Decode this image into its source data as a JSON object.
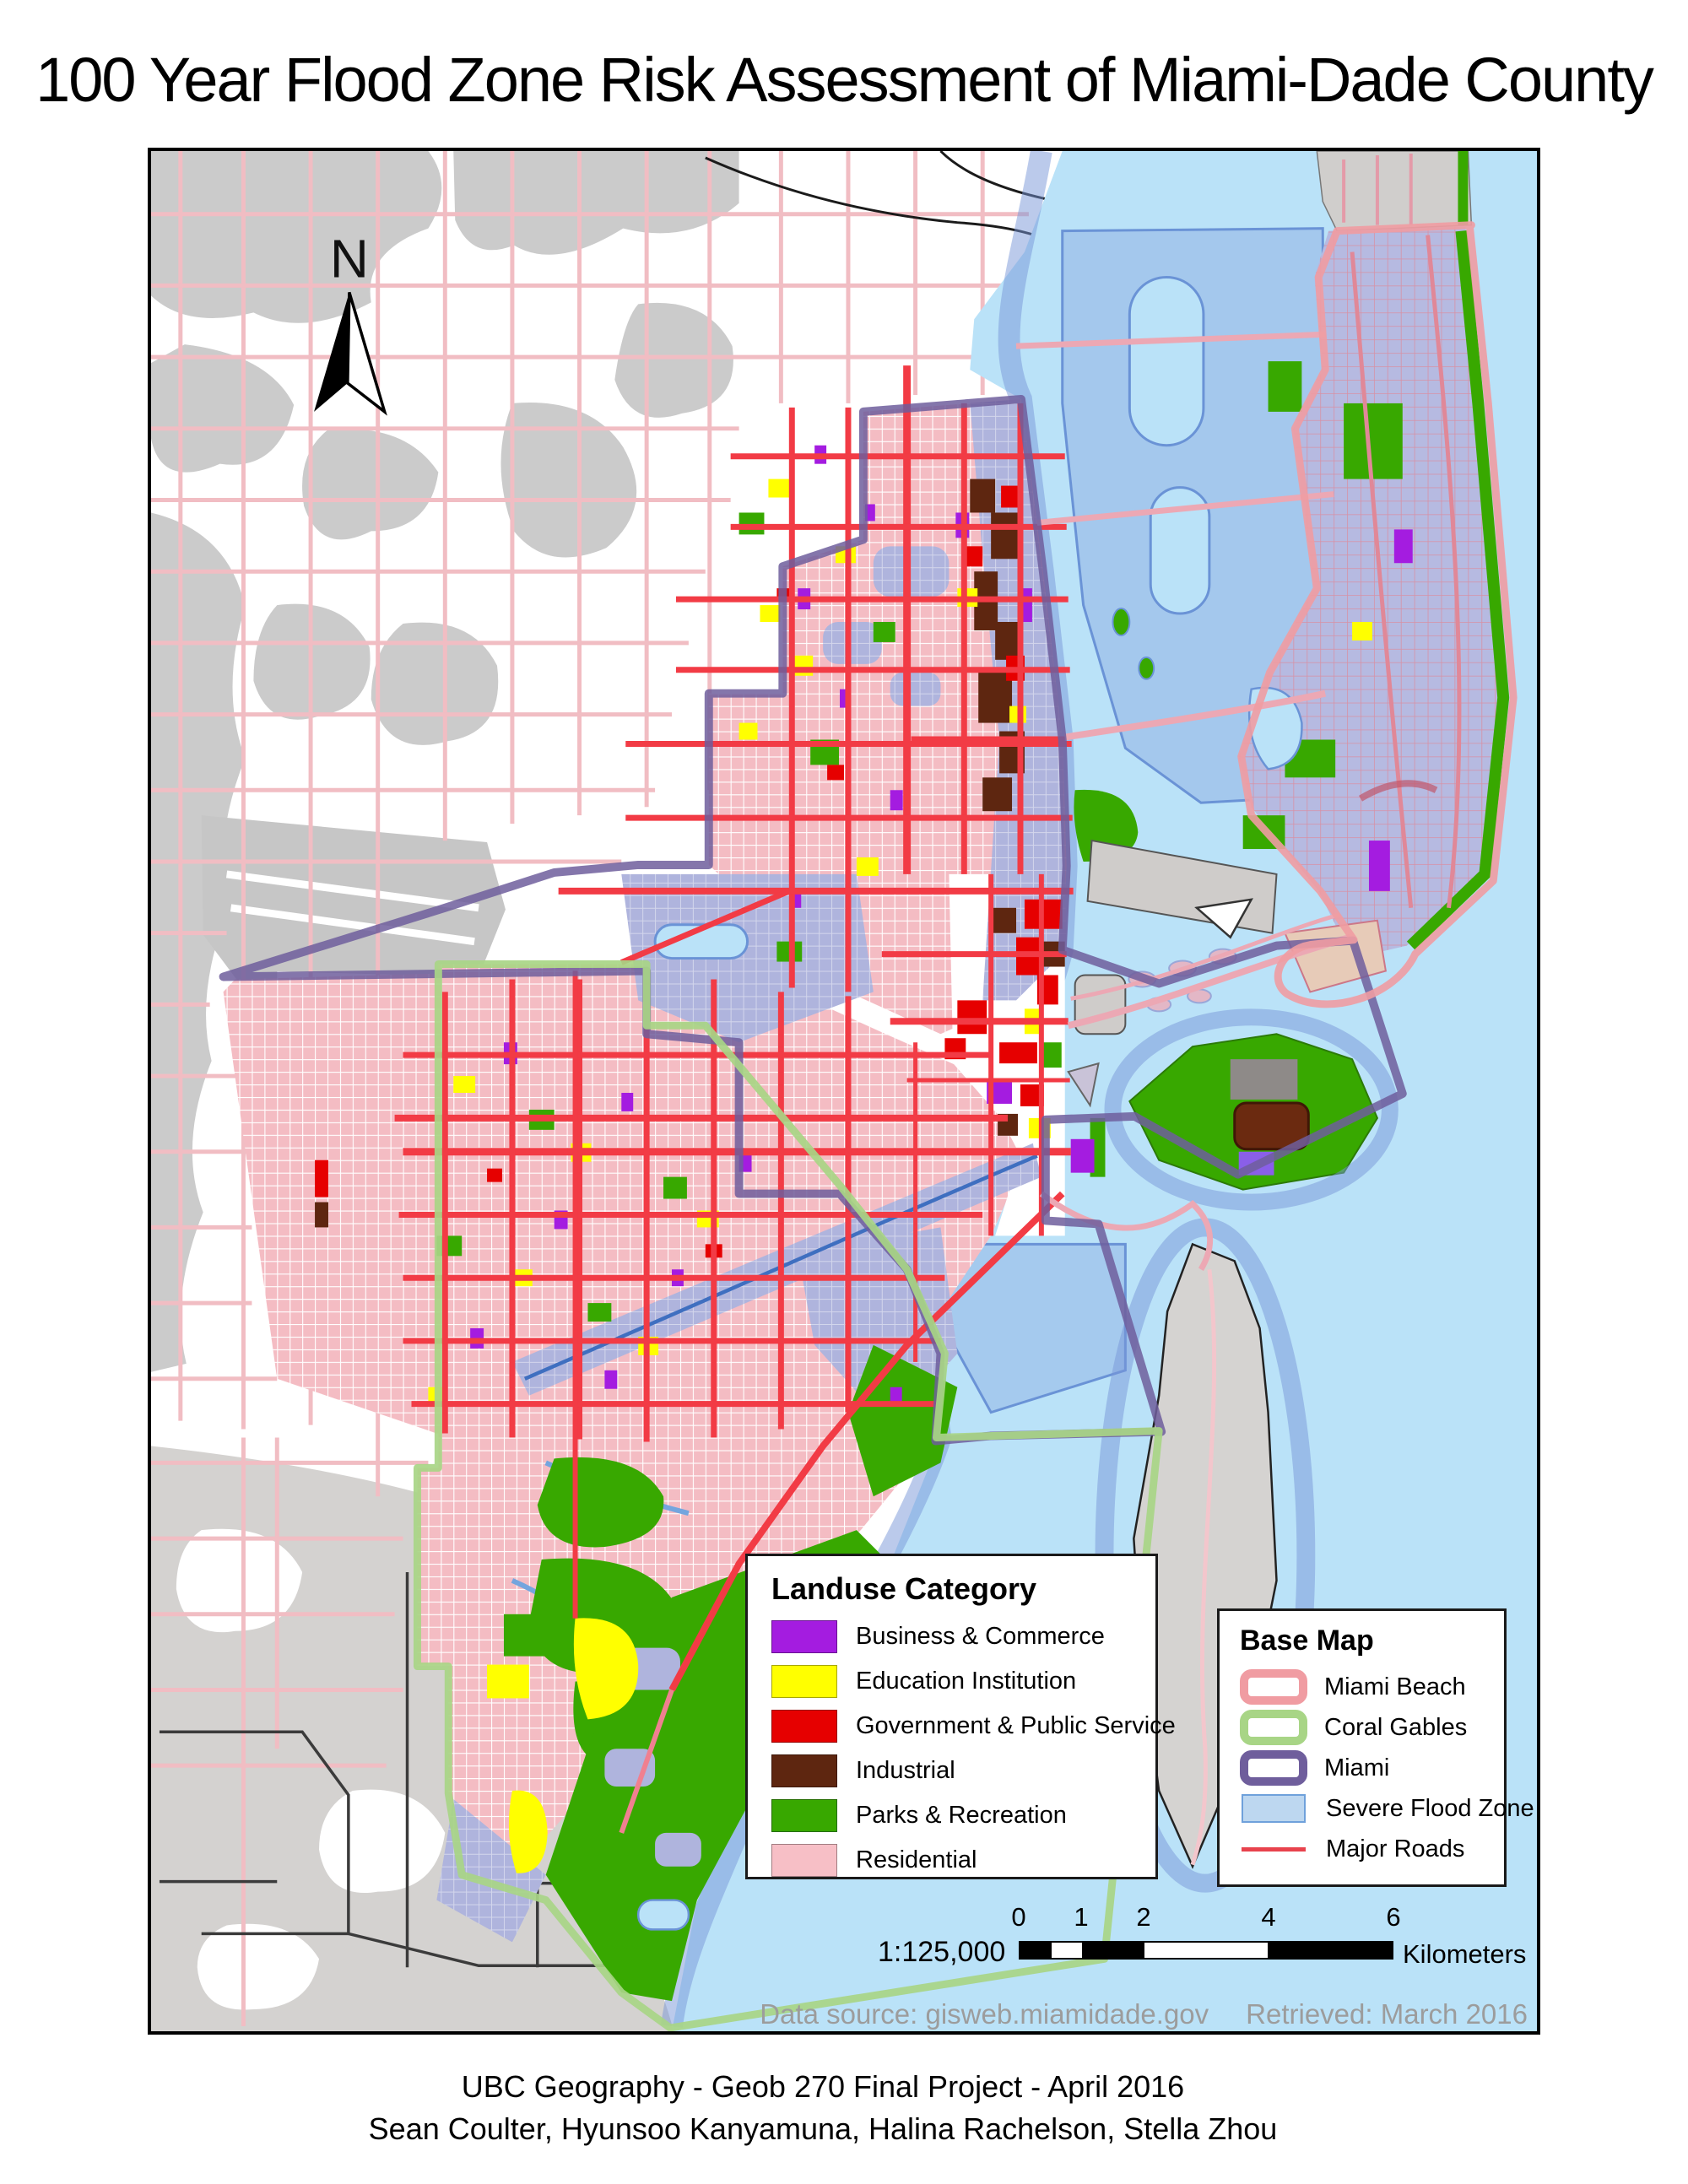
{
  "title": "100 Year Flood Zone Risk Assessment of Miami-Dade County",
  "north_arrow": {
    "label": "N"
  },
  "legend_landuse": {
    "title": "Landuse Category",
    "items": [
      {
        "label": "Business & Commerce",
        "color": "#A41CE0"
      },
      {
        "label": "Education Institution",
        "color": "#FFFF00"
      },
      {
        "label": "Government & Public Service",
        "color": "#E60000"
      },
      {
        "label": "Industrial",
        "color": "#5E2610"
      },
      {
        "label": "Parks & Recreation",
        "color": "#38A800"
      },
      {
        "label": "Residential",
        "color": "#F7BFC6"
      }
    ]
  },
  "legend_basemap": {
    "title": "Base Map",
    "items": [
      {
        "label": "Miami Beach",
        "type": "outline",
        "color": "#F09CA2"
      },
      {
        "label": "Coral Gables",
        "type": "outline",
        "color": "#A8D586"
      },
      {
        "label": "Miami",
        "type": "outline",
        "color": "#6F5E9C"
      },
      {
        "label": "Severe Flood Zone",
        "type": "fill",
        "color": "#BDD7F0",
        "border": "#6FA1DB"
      },
      {
        "label": "Major Roads",
        "type": "line",
        "color": "#E8424D"
      }
    ]
  },
  "scalebar": {
    "ratio": "1:125,000",
    "ticks": [
      "0",
      "1",
      "2",
      "4",
      "6"
    ],
    "unit": "Kilometers"
  },
  "attribution": {
    "source": "Data source: gisweb.miamidade.gov",
    "retrieved": "Retrieved: March 2016"
  },
  "footer": {
    "line1": "UBC Geography - Geob 270 Final Project - April 2016",
    "line2": "Sean Coulter, Hyunsoo Kanyamuna, Halina Rachelson, Stella Zhou"
  },
  "map_colors": {
    "water": "#BAE2F8",
    "flood_over_water": "#A9CDEF",
    "flood_border": "#6A93D6",
    "residential": "#F4BCC3",
    "flooded_residential": "#AFB4DD",
    "outside_urban_gray": "#CBCBCB",
    "outside_roads_pink": "#F1BDC3",
    "major_roads_red": "#F23B45",
    "parks_green": "#38A800"
  }
}
